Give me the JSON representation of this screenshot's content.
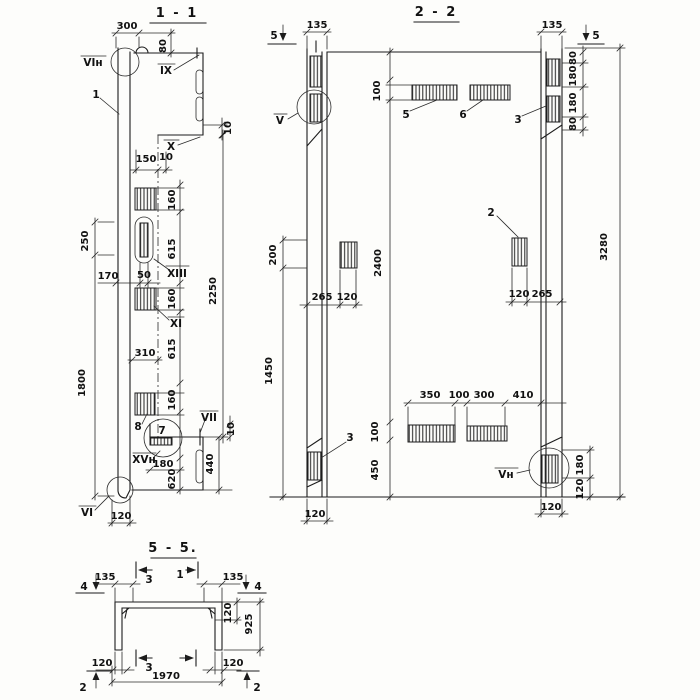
{
  "s11": {
    "title": "1 - 1",
    "dims": {
      "d300": "300",
      "d80": "80",
      "d10a": "10",
      "d150": "150",
      "d10b": "10",
      "d160a": "160",
      "d615a": "615",
      "d160b": "160",
      "d615b": "615",
      "d160c": "160",
      "d2250": "2250",
      "d250": "250",
      "d1800": "1800",
      "d170": "170",
      "d50": "50",
      "d310": "310",
      "d180": "180",
      "d620": "620",
      "d440": "440",
      "d10c": "10",
      "d120": "120"
    },
    "marks": {
      "vin": "VIн",
      "ix": "IX",
      "x": "X",
      "xiii": "XIII",
      "xi": "XI",
      "vii": "VII",
      "xvn": "XVн",
      "vi": "VI"
    },
    "parts": {
      "p1": "1",
      "p8": "8",
      "p7": "7"
    }
  },
  "s22": {
    "title": "2 - 2",
    "cuts": {
      "c5l": "5",
      "c5r": "5"
    },
    "dims": {
      "d135l": "135",
      "d135r": "135",
      "d80a": "80",
      "d180a": "180",
      "d180b": "180",
      "d80b": "80",
      "d3280": "3280",
      "d100t": "100",
      "d200": "200",
      "d1450": "1450",
      "d2400": "2400",
      "d265l": "265",
      "d120l1": "120",
      "d120r1": "120",
      "d265r": "265",
      "d350": "350",
      "d100m": "100",
      "d300": "300",
      "d410": "410",
      "d100b": "100",
      "d450": "450",
      "d180c": "180",
      "d120c": "120",
      "d120bl": "120",
      "d120br": "120"
    },
    "marks": {
      "v": "V",
      "vn": "Vн"
    },
    "parts": {
      "p5": "5",
      "p6": "6",
      "p3a": "3",
      "p2": "2",
      "p3b": "3"
    }
  },
  "s55": {
    "title": "5 - 5.",
    "cuts": {
      "c4l": "4",
      "c4r": "4",
      "c3t": "3",
      "c1t": "1",
      "c3b": "3",
      "c2l": "2",
      "c2r": "2"
    },
    "dims": {
      "d135l": "135",
      "d135r": "135",
      "d120t": "120",
      "d925": "925",
      "d120bl": "120",
      "d120br": "120",
      "d1970": "1970"
    }
  }
}
